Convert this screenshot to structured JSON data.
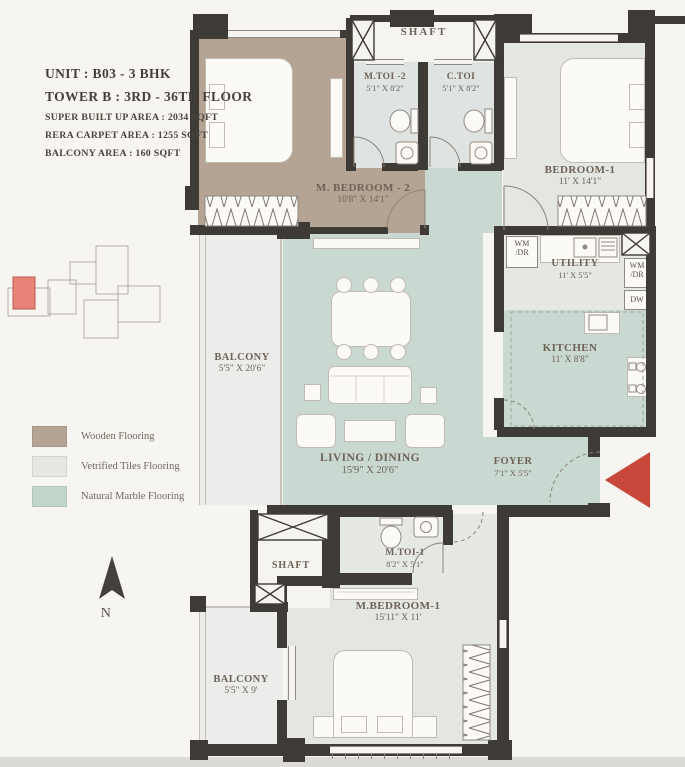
{
  "header": {
    "unit": "UNIT : B03 - 3 BHK",
    "tower": "TOWER B : 3RD - 36TH  FLOOR",
    "super_built_up": "SUPER BUILT UP AREA : 2034 SQFT",
    "rera_carpet": "RERA CARPET AREA : 1255 SQFT",
    "balcony_area": "BALCONY AREA : 160 SQFT"
  },
  "legend": {
    "items": [
      {
        "label": "Wooden Flooring",
        "color": "#b5a493"
      },
      {
        "label": "Vetrified Tiles Flooring",
        "color": "#e6e8e4"
      },
      {
        "label": "Natural Marble Flooring",
        "color": "#c2d7cc"
      }
    ]
  },
  "compass": {
    "label": "N"
  },
  "plan": {
    "rooms": {
      "shaft_top": {
        "name": "SHAFT"
      },
      "m_toi_2": {
        "name": "M.TOI -2",
        "dims": "5'1\" X 8'2\""
      },
      "c_toi": {
        "name": "C.TOI",
        "dims": "5'1\" X 8'2\""
      },
      "bedroom_1": {
        "name": "BEDROOM-1",
        "dims": "11' X 14'1\""
      },
      "m_bedroom_2": {
        "name": "M. BEDROOM - 2",
        "dims": "10'8\" X 14'1\""
      },
      "balcony_left": {
        "name": "BALCONY",
        "dims": "5'5\" X 20'6\""
      },
      "living_dining": {
        "name": "LIVING / DINING",
        "dims": "15'9\" X 20'6\""
      },
      "utility": {
        "name": "UTILITY",
        "dims": "11' X 5'5\""
      },
      "kitchen": {
        "name": "KITCHEN",
        "dims": "11' X 8'8\""
      },
      "foyer": {
        "name": "FOYER",
        "dims": "7'1\" X 5'5\""
      },
      "m_toi_1": {
        "name": "M.TOI-1",
        "dims": "8'2\" X 5'1\""
      },
      "shaft_bottom": {
        "name": "SHAFT"
      },
      "m_bedroom_1": {
        "name": "M.BEDROOM-1",
        "dims": "15'11\" X 11'"
      },
      "balcony_bottom": {
        "name": "BALCONY",
        "dims": "5'5\" X 9'"
      }
    },
    "appliances": {
      "wm_dr_left": {
        "line1": "WM",
        "line2": "/DR"
      },
      "wm_dr_right": {
        "line1": "WM",
        "line2": "/DR"
      },
      "dishwasher": "DW"
    },
    "colors": {
      "wall": "#3e3b36",
      "wooden_floor": "#b5a493",
      "tiles_floor": "#e6e8e4",
      "marble_floor": "#c9d8d0",
      "entry_arrow": "#c8493c",
      "keyplan_highlight": "#e8837a"
    }
  }
}
